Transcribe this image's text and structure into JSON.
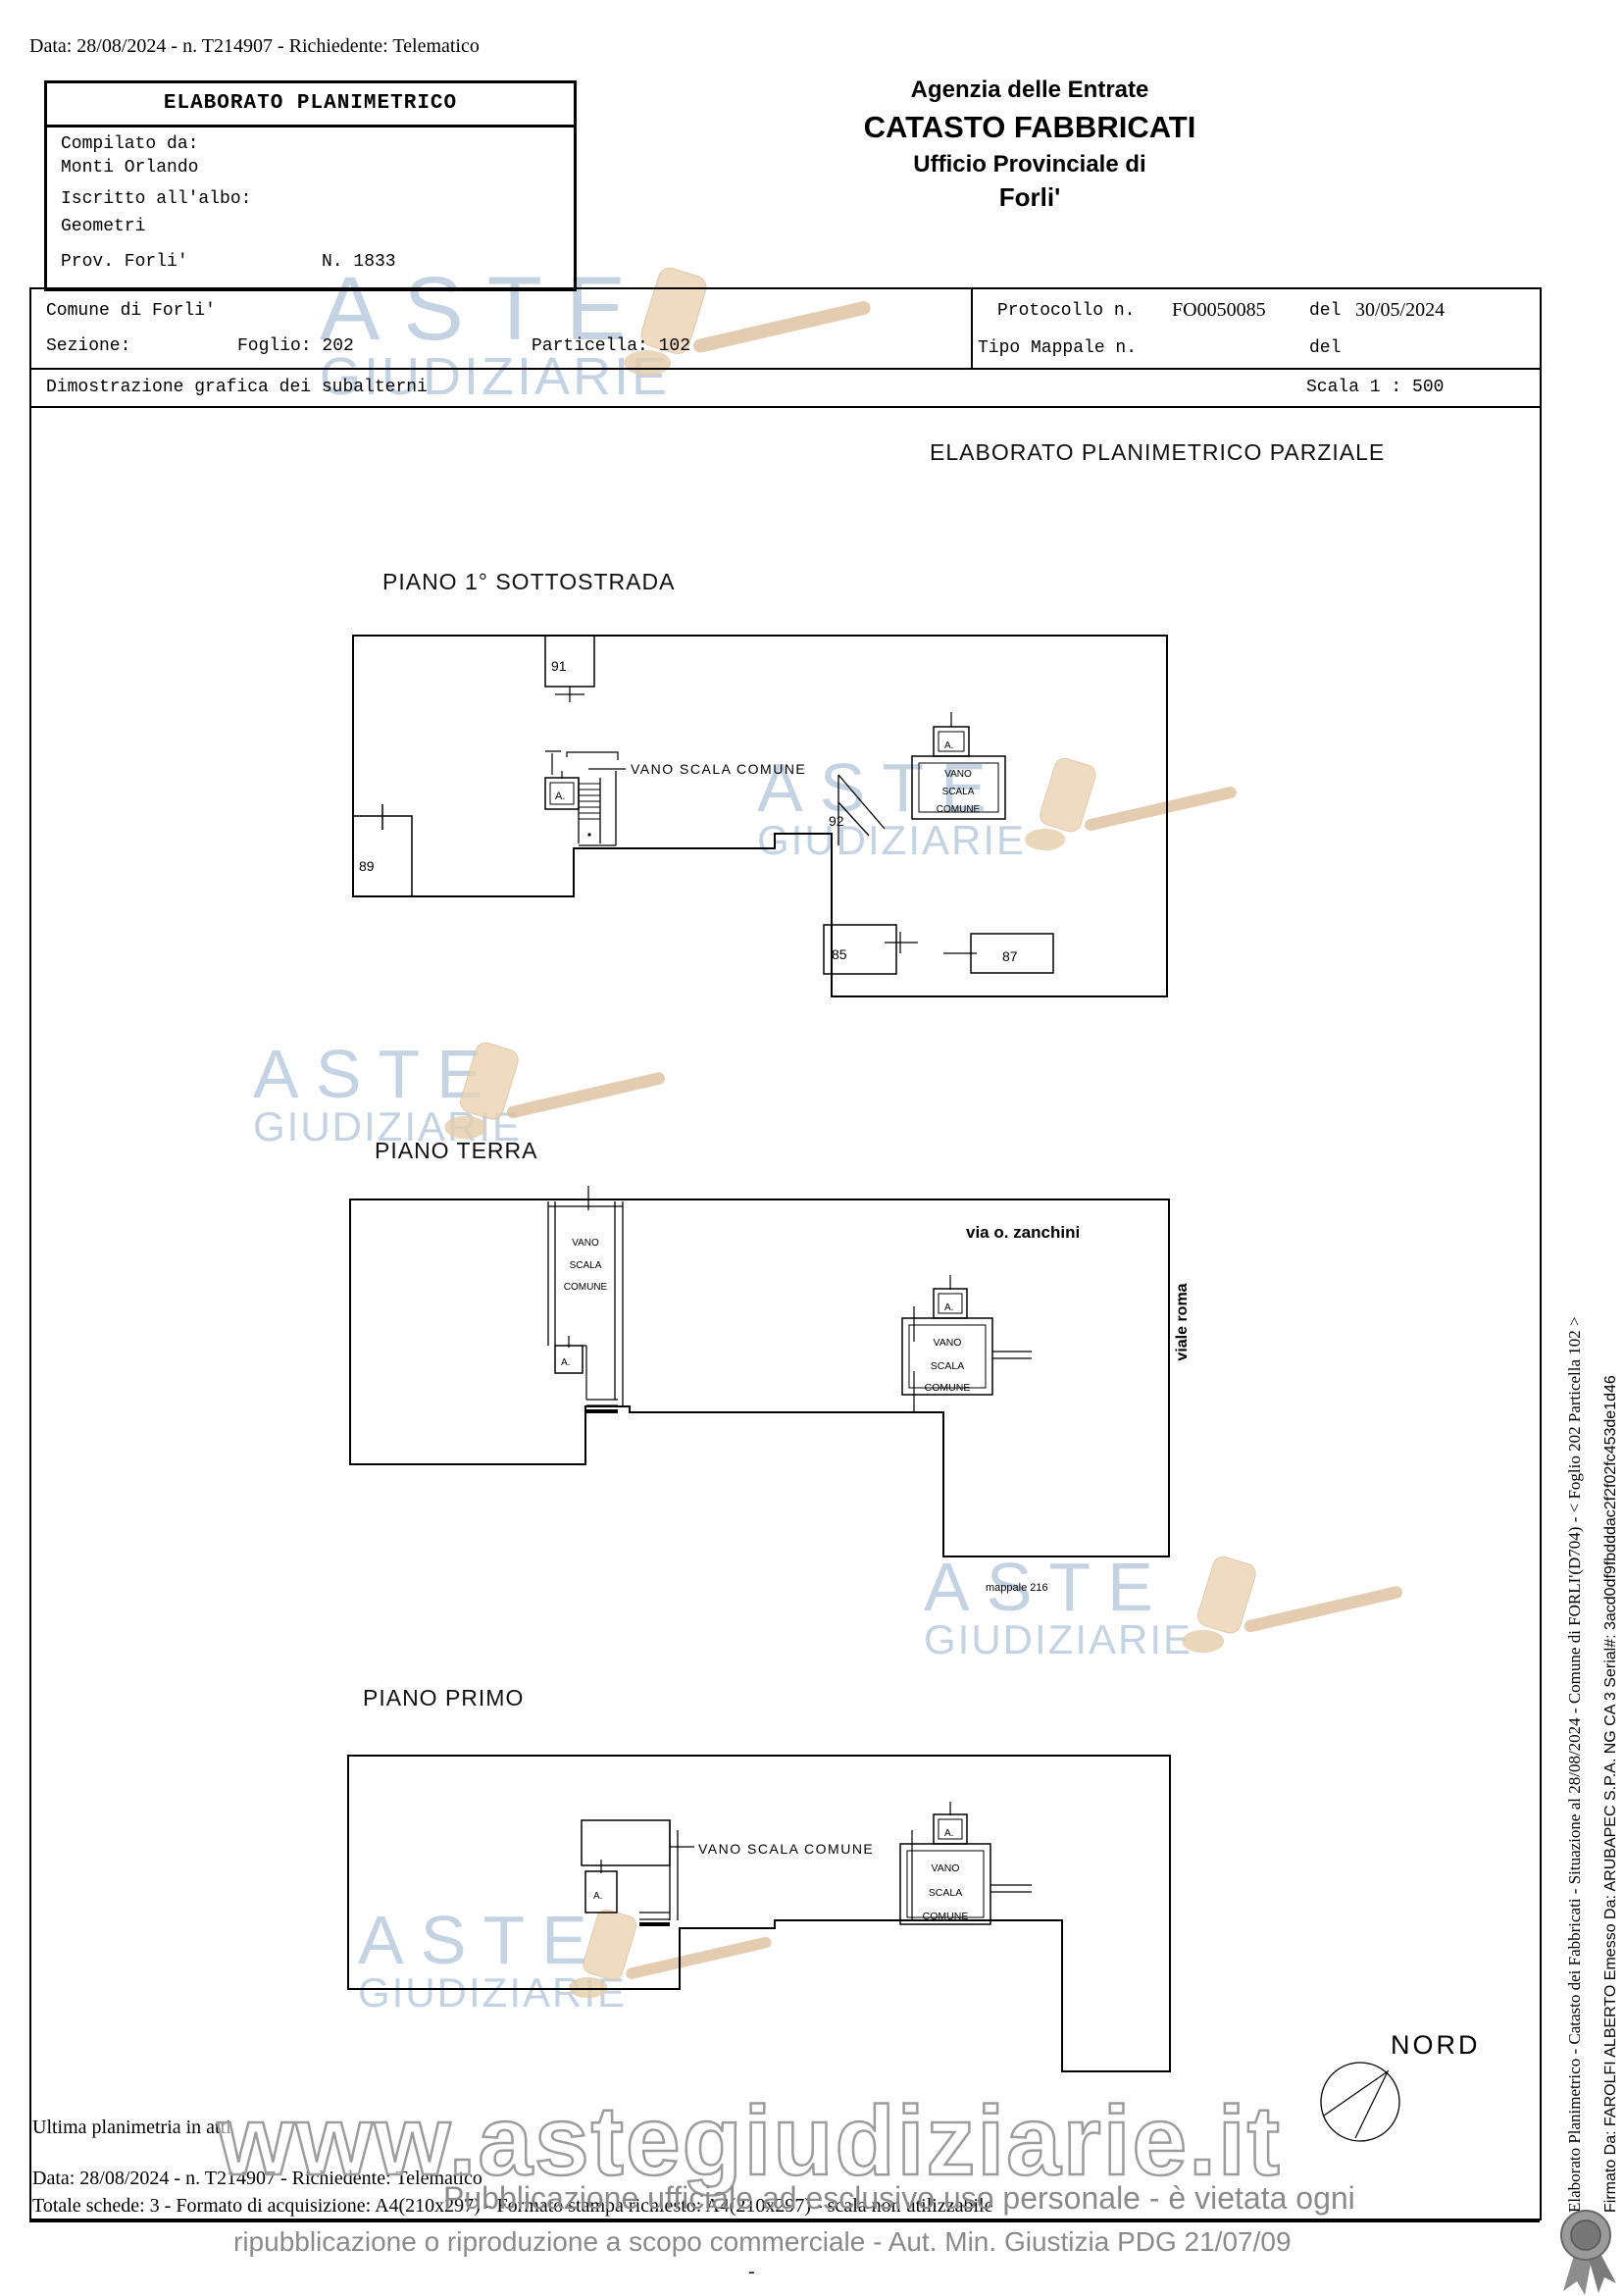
{
  "header": {
    "data_line": "Data: 28/08/2024 - n. T214907 - Richiedente: Telematico",
    "compiler": {
      "title": "ELABORATO PLANIMETRICO",
      "compilato_label": "Compilato da:",
      "compilato_value": "Monti Orlando",
      "albo_label": "Iscritto all'albo:",
      "albo_value": "Geometri",
      "prov": "Prov. Forli'",
      "num": "N. 1833"
    },
    "agency": {
      "line1": "Agenzia delle Entrate",
      "line2": "CATASTO FABBRICATI",
      "line3": "Ufficio Provinciale di",
      "line4": "Forli'"
    }
  },
  "info": {
    "comune": "Comune di Forli'",
    "sezione_label": "Sezione:",
    "foglio": "Foglio: 202",
    "particella": "Particella: 102",
    "protocollo_label": "Protocollo n.",
    "protocollo_value": "FO0050085",
    "del1": "del",
    "protocollo_date": "30/05/2024",
    "tipo_mappale": "Tipo Mappale n.",
    "del2": "del",
    "dimostrazione": "Dimostrazione grafica dei subalterni",
    "scala": "Scala 1 : 500",
    "parziale_title": "ELABORATO PLANIMETRICO PARZIALE"
  },
  "labels": {
    "vano_scala_comune": "VANO SCALA COMUNE",
    "vano": "VANO",
    "scala": "SCALA",
    "comune": "COMUNE",
    "a": "A."
  },
  "plans": {
    "p1": {
      "title": "PIANO 1° SOTTOSTRADA",
      "n91": "91",
      "n89": "89",
      "n92": "92",
      "n85": "85",
      "n87": "87"
    },
    "p2": {
      "title": "PIANO TERRA",
      "via": "via o. zanchini",
      "viale": "viale roma",
      "mappale": "mappale 216"
    },
    "p3": {
      "title": "PIANO PRIMO"
    }
  },
  "compass": {
    "label": "NORD"
  },
  "footer": {
    "ultima": "Ultima planimetria in atti",
    "data_line": "Data: 28/08/2024 - n. T214907 - Richiedente: Telematico",
    "totale": "Totale schede: 3 - Formato di acquisizione: A4(210x297) - Formato stampa richiesto: A4(210x297) - scala non utilizzabile",
    "dash": "-"
  },
  "watermark": {
    "aste": "ASTE",
    "giudiziarie": "GIUDIZIARIE",
    "www": "www.astegiudiziarie.it",
    "line1": "Pubblicazione ufficiale ad esclusivo uso personale - è vietata ogni",
    "line2": "ripubblicazione o riproduzione a scopo commerciale - Aut. Min. Giustizia PDG 21/07/09"
  },
  "sidebar": {
    "line1": "Elaborato Planimetrico - Catasto dei Fabbricati - Situazione al 28/08/2024 - Comune di FORLI'(D704) - < Foglio 202 Particella 102 >",
    "line2": "Firmato Da: FAROLFI ALBERTO Emesso Da: ARUBAPEC S.P.A. NG CA 3 Serial#: 3acd0df9fbdddac2f2f02fc453de1d46"
  }
}
